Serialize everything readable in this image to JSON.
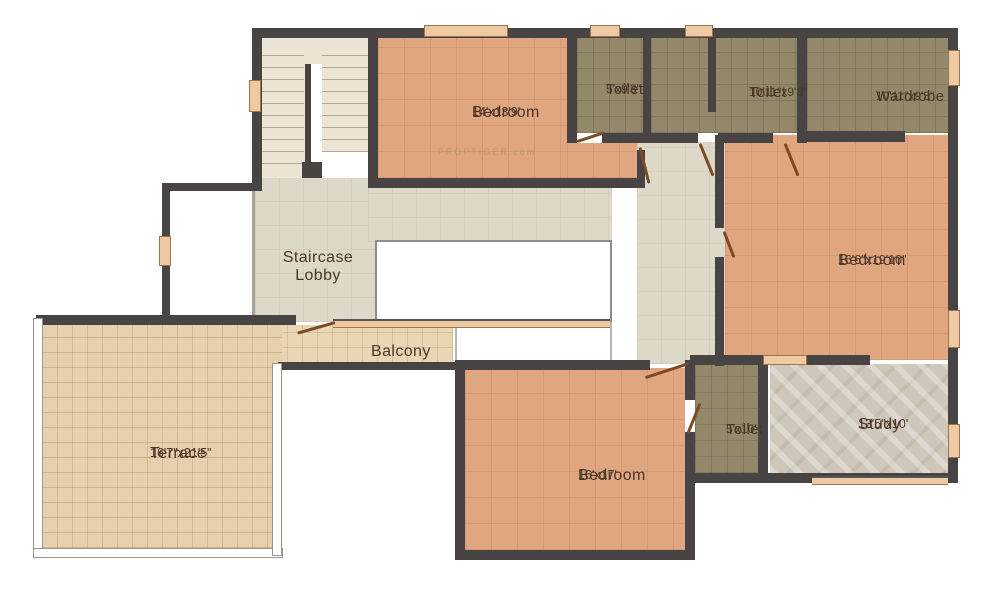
{
  "plan": {
    "title": "Floor Plan",
    "watermark": "PROPTIGER.com",
    "rooms": [
      {
        "id": "bedroom-top",
        "name": "Bedroom",
        "dims": "14'x13'9'"
      },
      {
        "id": "toilet-small-top",
        "name": "Toilet",
        "dims": "5'x9'3\""
      },
      {
        "id": "toilet-large-top",
        "name": "Toilet",
        "dims": "10'11\"x9'3\""
      },
      {
        "id": "wardrobe",
        "name": "Wardrobe",
        "dims": "10'11\"x9'3\""
      },
      {
        "id": "staircase-lobby",
        "name": "Staircase Lobby",
        "dims": ""
      },
      {
        "id": "bedroom-right",
        "name": "Bedroom",
        "dims": "16'6\"x19'10\""
      },
      {
        "id": "balcony",
        "name": "Balcony",
        "dims": ""
      },
      {
        "id": "terrace",
        "name": "Terrace",
        "dims": "16'7\"x21'5\""
      },
      {
        "id": "bedroom-bottom",
        "name": "Bedroom",
        "dims": "16'x17'"
      },
      {
        "id": "toilet-bottom",
        "name": "Toilet",
        "dims": "5'x10'"
      },
      {
        "id": "study",
        "name": "Study",
        "dims": "13'5\"x10'"
      }
    ],
    "colors": {
      "wall": "#474443",
      "bedroom": "#e0a67f",
      "wet": "#93886a",
      "lobby": "#ded8c9",
      "stair": "#ece5d6",
      "balcony": "#e9d6b5",
      "terrace": "#e6cfad",
      "study": "#cfc8ba",
      "window": "#eec9a2",
      "door": "#7d4a28",
      "label": "#4a3728",
      "voidborder": "#8d8d8d",
      "tread": "#b3a894"
    }
  }
}
